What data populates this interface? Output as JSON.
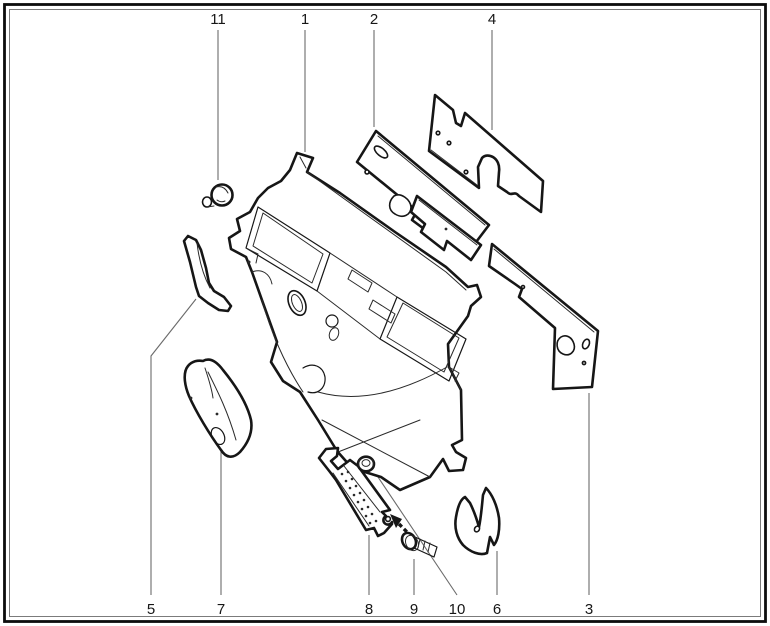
{
  "diagram": {
    "type": "exploded-parts-diagram",
    "description_visible_text_only": true,
    "callouts": [
      {
        "id": "callout-11",
        "label": "11"
      },
      {
        "id": "callout-1",
        "label": "1"
      },
      {
        "id": "callout-2",
        "label": "2"
      },
      {
        "id": "callout-4",
        "label": "4"
      },
      {
        "id": "callout-5",
        "label": "5"
      },
      {
        "id": "callout-7",
        "label": "7"
      },
      {
        "id": "callout-8",
        "label": "8"
      },
      {
        "id": "callout-9",
        "label": "9"
      },
      {
        "id": "callout-10",
        "label": "10"
      },
      {
        "id": "callout-6",
        "label": "6"
      },
      {
        "id": "callout-3",
        "label": "3"
      }
    ],
    "colors": {
      "background": "#ffffff",
      "part_outline": "#161616",
      "leader_line": "#6b6b6b",
      "label_text": "#161616"
    }
  }
}
